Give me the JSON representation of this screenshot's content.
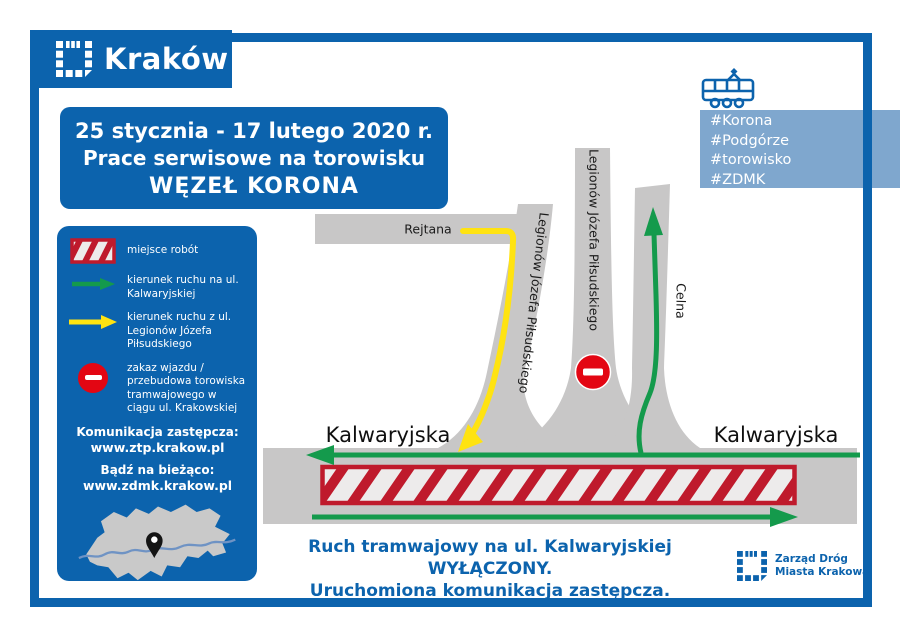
{
  "brand": {
    "city_logo_text": "Kraków"
  },
  "title": {
    "line1": "25 stycznia - 17 lutego 2020 r.",
    "line2": "Prace serwisowe na torowisku",
    "line3": "WĘZEŁ KORONA"
  },
  "hashtags": {
    "items": [
      "#Korona",
      "#Podgórze",
      "#torowisko",
      "#ZDMK"
    ]
  },
  "legend": {
    "work_area": "miejsce robót",
    "green_arrow": "kierunek ruchu na ul. Kalwaryjskiej",
    "yellow_arrow": "kierunek ruchu z ul. Legionów Józefa Piłsudskiego",
    "no_entry": "zakaz wjazdu / przebudowa torowiska tramwajowego w ciągu ul. Krakowskiej",
    "replacement_heading": "Komunikacja zastępcza:",
    "replacement_url": "www.ztp.krakow.pl",
    "updates_heading": "Bądź na bieżąco:",
    "updates_url": "www.zdmk.krakow.pl"
  },
  "roads": {
    "rejtana": "Rejtana",
    "legionow_left": "Legionów Józefa Piłsudskiego",
    "legionow_middle": "Legionów Józefa Piłsudskiego",
    "celna": "Celna",
    "kalwaryjska_left": "Kalwaryjska",
    "kalwaryjska_right": "Kalwaryjska"
  },
  "footer": {
    "notice_line1": "Ruch tramwajowy na ul. Kalwaryjskiej WYŁĄCZONY.",
    "notice_line2": "Uruchomiona komunikacja zastępcza.",
    "zdmk_line1": "Zarząd Dróg",
    "zdmk_line2": "Miasta Krakowa"
  },
  "colors": {
    "primary_blue": "#0c63ad",
    "light_blue": "#7fa7ce",
    "road_gray": "#c8c7c7",
    "hatch_red": "#bf1a2c",
    "sign_red": "#e30613",
    "green": "#149a4c",
    "yellow": "#ffe311"
  }
}
